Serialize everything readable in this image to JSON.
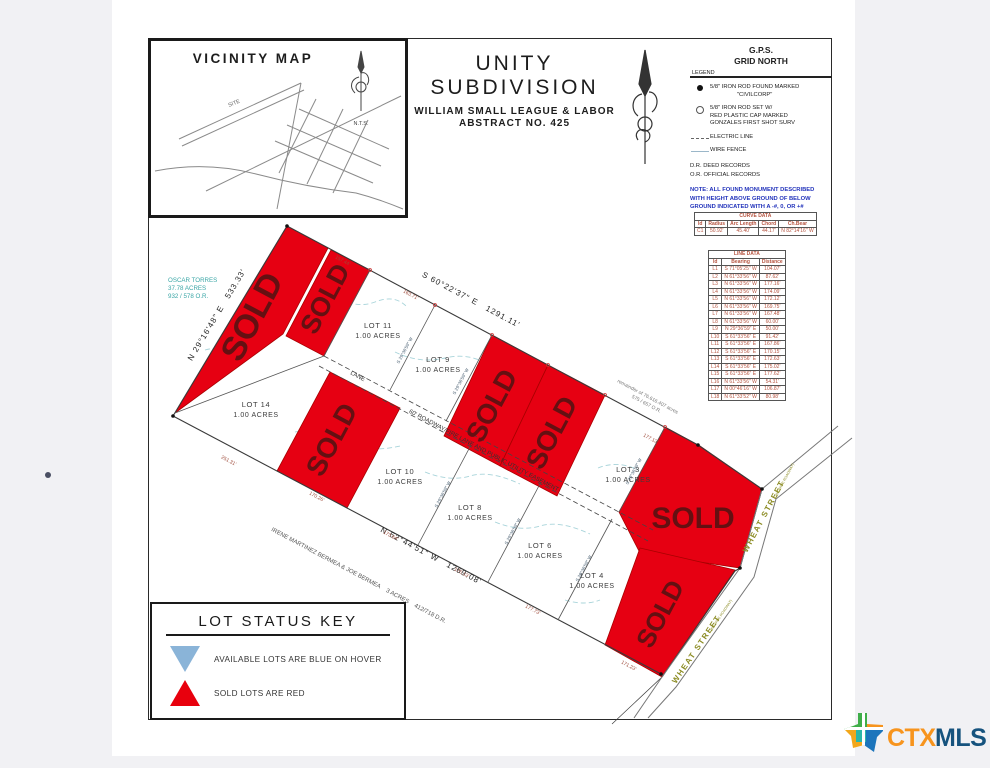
{
  "colors": {
    "page_bg": "#f1f1f4",
    "sold_fill": "#e60012",
    "sold_text": "#641012",
    "street_label": "#8b8b22",
    "note_blue": "#2233bb",
    "table_text": "#b5533f",
    "owner_teal": "#3aa6a6",
    "available_key_blue": "#8ab4d8",
    "logo_orange": "#f7941d",
    "logo_navy": "#16537e"
  },
  "vicinity": {
    "title": "VICINITY MAP",
    "site": "SITE",
    "nts": "N.T.S."
  },
  "title_block": {
    "line1": "UNITY SUBDIVISION",
    "line2": "WILLIAM SMALL LEAGUE & LABOR",
    "line3": "ABSTRACT NO. 425"
  },
  "legend": {
    "gps_line1": "G.P.S.",
    "gps_line2": "GRID NORTH",
    "heading": "LEGEND",
    "item1_line1": "5/8\" IRON ROD FOUND MARKED",
    "item1_line2": "\"CIVILCORP\"",
    "item2_line1": "5/8\" IRON ROD SET W/",
    "item2_line2": "RED PLASTIC CAP MARKED",
    "item2_line3": "GONZALES FIRST SHOT SURV",
    "item3": "ELECTRIC LINE",
    "item4": "WIRE FENCE",
    "rec1": "D.R.   DEED RECORDS",
    "rec2": "O.R.   OFFICIAL RECORDS",
    "note1": "NOTE: ALL FOUND MONUMENT DESCRIBED",
    "note2": "WITH HEIGHT ABOVE GROUND OF BELOW",
    "note3": "GROUND INDICATED WITH A -#, 0, OR +#"
  },
  "curve_table": {
    "title": "CURVE DATA",
    "headers": [
      "Id",
      "Radius",
      "Arc Length",
      "Chord",
      "Ch.Bear"
    ],
    "rows": [
      [
        "C1",
        "50.92'",
        "45.40'",
        "44.17'",
        "N 82°14'16\" W"
      ]
    ]
  },
  "line_table": {
    "title": "LINE DATA",
    "headers": [
      "Id",
      "Bearing",
      "Distance"
    ],
    "rows": [
      [
        "L1",
        "S 71°05'25\" W",
        "104.07'"
      ],
      [
        "L2",
        "N 61°33'56\" W",
        "87.62'"
      ],
      [
        "L3",
        "N 61°33'56\" W",
        "177.16'"
      ],
      [
        "L4",
        "N 61°33'56\" W",
        "174.09'"
      ],
      [
        "L5",
        "N 61°33'56\" W",
        "172.12'"
      ],
      [
        "L6",
        "N 61°33'56\" W",
        "169.75'"
      ],
      [
        "L7",
        "N 61°33'56\" W",
        "167.48'"
      ],
      [
        "L8",
        "N 61°33'56\" W",
        "60.00'"
      ],
      [
        "L9",
        "N 29°36'59\" E",
        "50.00'"
      ],
      [
        "L10",
        "S 61°33'56\" E",
        "91.42'"
      ],
      [
        "L11",
        "S 61°33'56\" E",
        "167.86'"
      ],
      [
        "L12",
        "S 61°33'56\" E",
        "170.15'"
      ],
      [
        "L13",
        "S 61°33'56\" E",
        "172.63'"
      ],
      [
        "L14",
        "S 61°33'56\" E",
        "175.02'"
      ],
      [
        "L15",
        "S 61°33'56\" E",
        "177.62'"
      ],
      [
        "L16",
        "N 61°33'56\" W",
        "54.31'"
      ],
      [
        "L17",
        "N 00°46'16\" W",
        "106.87'"
      ],
      [
        "L18",
        "N 61°33'52\" W",
        "80.98'"
      ]
    ]
  },
  "plat": {
    "sold_label": "SOLD",
    "lots": [
      {
        "name": "LOT 14",
        "acres": "1.00 ACRES"
      },
      {
        "name": "LOT 11",
        "acres": "1.00 ACRES"
      },
      {
        "name": "LOT 9",
        "acres": "1.00 ACRES"
      },
      {
        "name": "LOT 10",
        "acres": "1.00 ACRES"
      },
      {
        "name": "LOT 8",
        "acres": "1.00 ACRES"
      },
      {
        "name": "LOT 6",
        "acres": "1.00 ACRES"
      },
      {
        "name": "LOT 4",
        "acres": "1.00 ACRES"
      },
      {
        "name": "LOT 3",
        "acres": "1.00 ACRES"
      }
    ],
    "bearing_top": "S 60°22'37\" E   1291.11'",
    "bearing_left": "N 29°16'48\" E   533.33'",
    "bearing_bottom": "N 62°44'51\" W   1269.08'",
    "owner_nw1": "OSCAR TORRES",
    "owner_nw2": "37.78 ACRES",
    "owner_nw3": "932 / 578 O.R.",
    "owner_sw": "IRENE MARTINEZ BERMEA & JOE BERMEA    3 ACRES    412/718 D.R.",
    "remainder1": "remainder of 76.616.407 acres",
    "remainder2": "575 / 657 O.R.",
    "lane_short": "LANE",
    "lane_full": "60' ROADWAY/FIRE LANE AND PUBLIC UTILITY EASEMENT",
    "street_name": "WHEAT STREET",
    "street_sub": "(60' WIDE ROADWAY)",
    "dims": [
      "157.44'",
      "163.71'",
      "177.13'",
      "251.31'",
      "170.26'",
      "173.64'",
      "175.13'",
      "177.73'",
      "171.23'"
    ],
    "cross_bearing": "S 29°36'59\" W"
  },
  "status_key": {
    "title": "LOT STATUS KEY",
    "available": "AVAILABLE LOTS ARE BLUE ON HOVER",
    "sold": "SOLD LOTS ARE RED"
  },
  "logo": {
    "ctx": "CTX",
    "mls": "MLS"
  }
}
